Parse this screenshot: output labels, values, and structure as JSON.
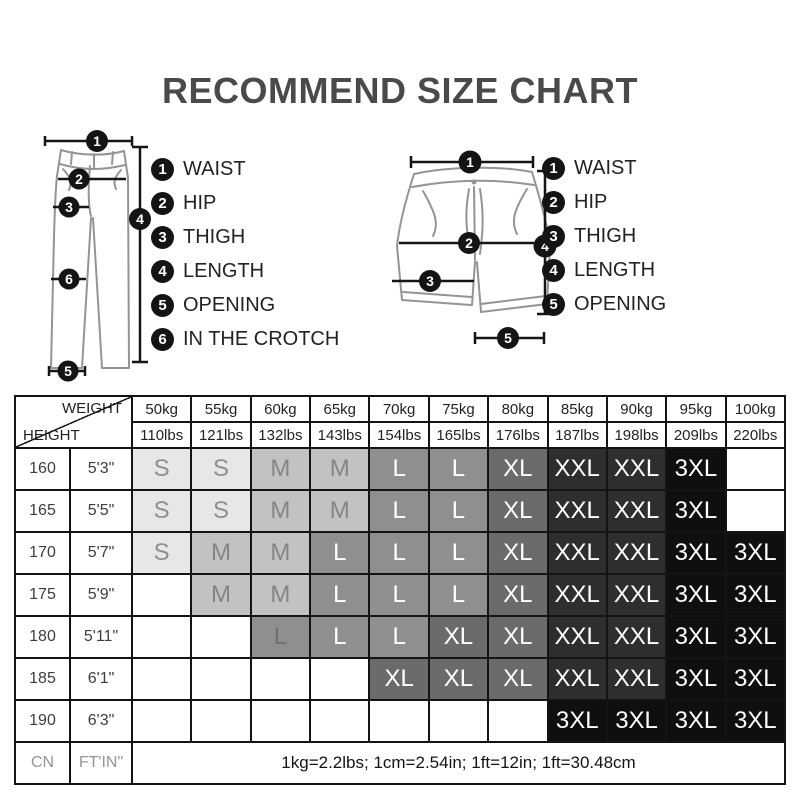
{
  "title": "RECOMMEND SIZE CHART",
  "pants_legend": [
    {
      "num": "1",
      "label": "WAIST"
    },
    {
      "num": "2",
      "label": "HIP"
    },
    {
      "num": "3",
      "label": "THIGH"
    },
    {
      "num": "4",
      "label": "LENGTH"
    },
    {
      "num": "5",
      "label": "OPENING"
    },
    {
      "num": "6",
      "label": "IN THE CROTCH"
    }
  ],
  "shorts_legend": [
    {
      "num": "1",
      "label": "WAIST"
    },
    {
      "num": "2",
      "label": "HIP"
    },
    {
      "num": "3",
      "label": "THIGH"
    },
    {
      "num": "4",
      "label": "LENGTH"
    },
    {
      "num": "5",
      "label": "OPENING"
    }
  ],
  "table": {
    "corner": {
      "top": "WEIGHT",
      "bottom": "HEIGHT"
    },
    "weights_kg": [
      "50kg",
      "55kg",
      "60kg",
      "65kg",
      "70kg",
      "75kg",
      "80kg",
      "85kg",
      "90kg",
      "95kg",
      "100kg"
    ],
    "weights_lbs": [
      "110lbs",
      "121lbs",
      "132lbs",
      "143lbs",
      "154lbs",
      "165lbs",
      "176lbs",
      "187lbs",
      "198lbs",
      "209lbs",
      "220lbs"
    ],
    "palette": {
      "S": {
        "bg": "#e7e7e7",
        "fg": "#8f8f8f"
      },
      "M": {
        "bg": "#c2c2c2",
        "fg": "#858585"
      },
      "L": {
        "bg": "#8f8f8f",
        "fg": "#ffffff"
      },
      "XL": {
        "bg": "#6b6b6b",
        "fg": "#ffffff"
      },
      "XXL": {
        "bg": "#2e2e2e",
        "fg": "#ffffff"
      },
      "3XL": {
        "bg": "#0f0f0f",
        "fg": "#ffffff"
      }
    },
    "rows": [
      {
        "cn": "160",
        "ftin": "5'3\"",
        "sizes": [
          "S",
          "S",
          "M",
          "M",
          "L",
          "L",
          "XL",
          "XXL",
          "XXL",
          "3XL",
          ""
        ]
      },
      {
        "cn": "165",
        "ftin": "5'5\"",
        "sizes": [
          "S",
          "S",
          "M",
          "M",
          "L",
          "L",
          "XL",
          "XXL",
          "XXL",
          "3XL",
          ""
        ]
      },
      {
        "cn": "170",
        "ftin": "5'7\"",
        "sizes": [
          "S",
          "M",
          "M",
          "L",
          "L",
          "L",
          "XL",
          "XXL",
          "XXL",
          "3XL",
          "3XL"
        ]
      },
      {
        "cn": "175",
        "ftin": "5'9\"",
        "sizes": [
          "",
          "M",
          "M",
          "L",
          "L",
          "L",
          "XL",
          "XXL",
          "XXL",
          "3XL",
          "3XL"
        ]
      },
      {
        "cn": "180",
        "ftin": "5'11\"",
        "sizes": [
          "",
          "",
          "L",
          "L",
          "L",
          "XL",
          "XL",
          "XXL",
          "XXL",
          "3XL",
          "3XL"
        ]
      },
      {
        "cn": "185",
        "ftin": "6'1\"",
        "sizes": [
          "",
          "",
          "",
          "",
          "XL",
          "XL",
          "XL",
          "XXL",
          "XXL",
          "3XL",
          "3XL"
        ]
      },
      {
        "cn": "190",
        "ftin": "6'3\"",
        "sizes": [
          "",
          "",
          "",
          "",
          "",
          "",
          "",
          "3XL",
          "3XL",
          "3XL",
          "3XL"
        ]
      }
    ],
    "muted_cells": [
      {
        "row": 4,
        "col": 2,
        "fg": "#6f6f6f"
      }
    ],
    "footer": {
      "cn": "CN",
      "ftin": "FT'IN\"",
      "note": "1kg=2.2lbs; 1cm=2.54in; 1ft=12in; 1ft=30.48cm"
    }
  }
}
